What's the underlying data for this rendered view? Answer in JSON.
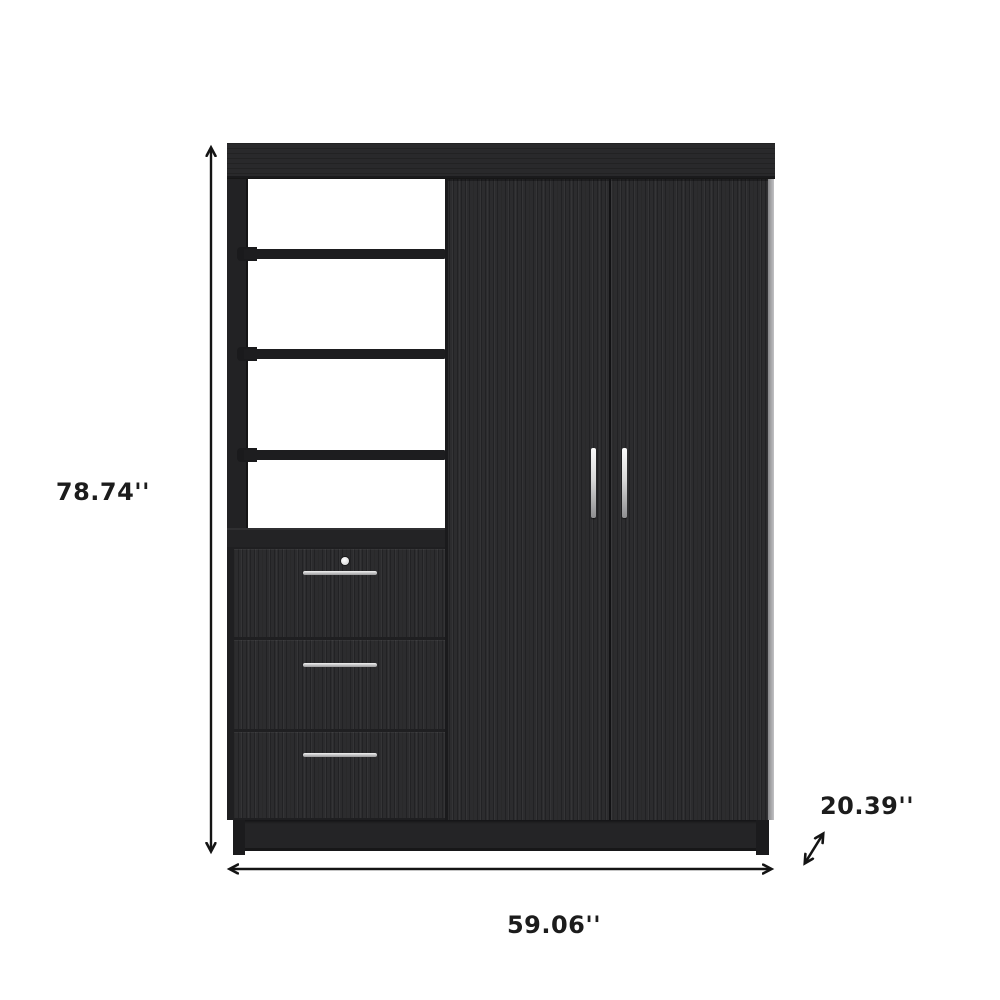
{
  "dimensions": {
    "height_label": "78.74''",
    "width_label": "59.06''",
    "depth_label": "20.39''"
  },
  "furniture": {
    "shelf_count": 3,
    "drawer_count": 3,
    "door_count": 2,
    "colors": {
      "panel_dark": "#2c2c2e",
      "panel_darker": "#1f1f21",
      "cornice": "#29292b",
      "handle_silver": "#d8d8d8",
      "side_edge_highlight": "#c2c2c4",
      "background": "#ffffff",
      "annotation_ink": "#141414"
    }
  },
  "icons": {
    "height_arrow": "vertical-double-arrow",
    "width_arrow": "horizontal-double-arrow",
    "depth_arrow": "diagonal-double-arrow"
  }
}
